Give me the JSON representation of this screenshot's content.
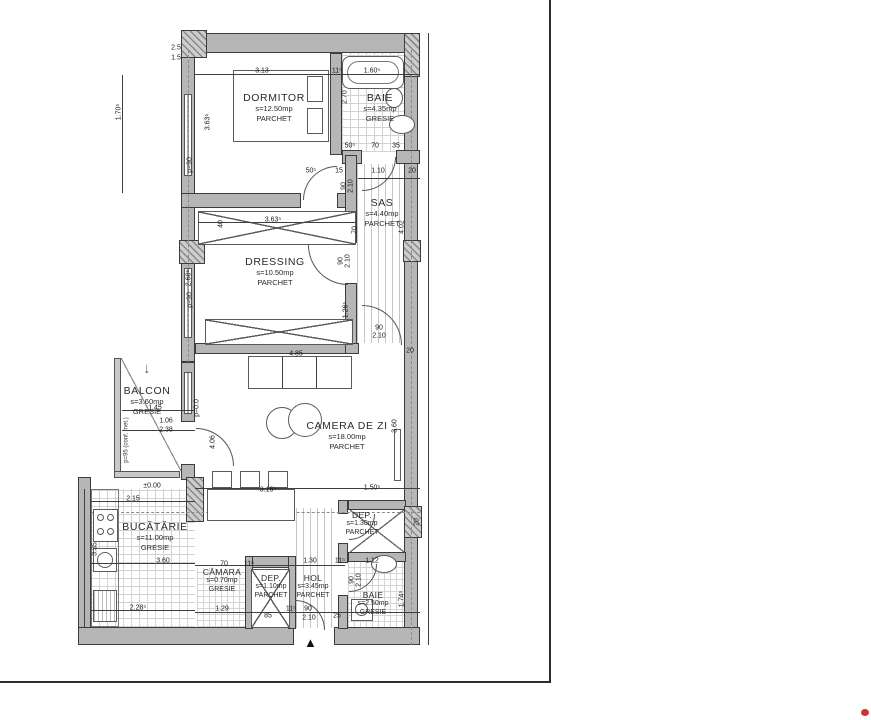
{
  "colors": {
    "wall": "#b6b6b6",
    "line": "#3c3c3c",
    "frame": "#2c2c2c",
    "dot": "#d03030"
  },
  "icons": {
    "balcony_arrow": "↓",
    "entrance_marker": "▲"
  },
  "rooms": [
    {
      "id": "dormitor",
      "name": "DORMITOR",
      "area": "s=12.50mp",
      "floor": "PARCHET",
      "x": 274,
      "y": 92
    },
    {
      "id": "baie-1",
      "name": "BAIE",
      "area": "s=4.35mp",
      "floor": "GRESIE",
      "x": 380,
      "y": 92
    },
    {
      "id": "sas",
      "name": "SAS",
      "area": "s=4.40mp",
      "floor": "PARCHET",
      "x": 382,
      "y": 197
    },
    {
      "id": "dressing",
      "name": "DRESSING",
      "area": "s=10.50mp",
      "floor": "PARCHET",
      "x": 275,
      "y": 256
    },
    {
      "id": "balcon",
      "name": "BALCON",
      "area": "s=3.60mp",
      "floor": "GRESIE",
      "x": 147,
      "y": 385
    },
    {
      "id": "camera-de-zi",
      "name": "CAMERA DE ZI",
      "area": "s=18.00mp",
      "floor": "PARCHET",
      "x": 347,
      "y": 420
    },
    {
      "id": "bucatarie",
      "name": "BUCĂTĂRIE",
      "area": "s=11.00mp",
      "floor": "GRESIE",
      "x": 155,
      "y": 521
    },
    {
      "id": "camara",
      "name": "CĂMARA",
      "area": "s=0.70mp",
      "floor": "GRESIE",
      "sm": 1,
      "x": 222,
      "y": 567
    },
    {
      "id": "dep-1",
      "name": "DEP.",
      "area": "s=1.10mp",
      "floor": "PARCHET",
      "sm": 1,
      "x": 271,
      "y": 573
    },
    {
      "id": "hol",
      "name": "HOL",
      "area": "s=3.45mp",
      "floor": "PARCHET",
      "sm": 1,
      "x": 313,
      "y": 573
    },
    {
      "id": "dep-2",
      "name": "DEP.",
      "area": "s=1.30mp",
      "floor": "PARCHET",
      "sm": 1,
      "x": 362,
      "y": 510
    },
    {
      "id": "baie-2",
      "name": "BAIE",
      "area": "s=2.50mp",
      "floor": "GRESIE",
      "sm": 1,
      "x": 373,
      "y": 590
    }
  ],
  "dims": [
    {
      "t": "2.5",
      "x": 176,
      "y": 48
    },
    {
      "t": "1.5",
      "x": 176,
      "y": 58
    },
    {
      "t": "3.13",
      "x": 262,
      "y": 71
    },
    {
      "t": "11⁵",
      "x": 337,
      "y": 71
    },
    {
      "t": "1.60⁵",
      "x": 372,
      "y": 71
    },
    {
      "t": "1.70⁵",
      "x": 119,
      "y": 112,
      "r": 1
    },
    {
      "t": "3.63⁵",
      "x": 208,
      "y": 122,
      "r": 1
    },
    {
      "t": "2.70",
      "x": 345,
      "y": 97,
      "r": 1
    },
    {
      "t": "50⁵",
      "x": 350,
      "y": 146
    },
    {
      "t": "70",
      "x": 375,
      "y": 146
    },
    {
      "t": "35",
      "x": 396,
      "y": 146
    },
    {
      "t": "50⁵",
      "x": 311,
      "y": 171
    },
    {
      "t": "15",
      "x": 339,
      "y": 171
    },
    {
      "t": "1.10",
      "x": 378,
      "y": 171
    },
    {
      "t": "20",
      "x": 412,
      "y": 171
    },
    {
      "t": "90",
      "x": 344,
      "y": 186,
      "r": 1
    },
    {
      "t": "2.10",
      "x": 351,
      "y": 186,
      "r": 1
    },
    {
      "t": "3.63⁵",
      "x": 273,
      "y": 220
    },
    {
      "t": "40",
      "x": 221,
      "y": 224,
      "r": 1
    },
    {
      "t": "70",
      "x": 355,
      "y": 230,
      "r": 1
    },
    {
      "t": "4.02",
      "x": 402,
      "y": 227,
      "r": 1
    },
    {
      "t": "2.68⁵",
      "x": 189,
      "y": 278,
      "r": 1
    },
    {
      "t": "90",
      "x": 341,
      "y": 261,
      "r": 1
    },
    {
      "t": "2.10",
      "x": 348,
      "y": 261,
      "r": 1
    },
    {
      "t": "1.26⁵",
      "x": 346,
      "y": 310,
      "r": 1
    },
    {
      "t": "90",
      "x": 379,
      "y": 328
    },
    {
      "t": "2.10",
      "x": 379,
      "y": 336
    },
    {
      "t": "20",
      "x": 410,
      "y": 351
    },
    {
      "t": "4.85",
      "x": 296,
      "y": 354
    },
    {
      "t": "p=90",
      "x": 190,
      "y": 165,
      "r": 1
    },
    {
      "t": "p=90",
      "x": 190,
      "y": 300,
      "r": 1
    },
    {
      "t": "p=0.0",
      "x": 197,
      "y": 408,
      "r": 1
    },
    {
      "t": "1.45",
      "x": 155,
      "y": 408
    },
    {
      "t": "1.06",
      "x": 166,
      "y": 421
    },
    {
      "t": "2.38",
      "x": 166,
      "y": 430
    },
    {
      "t": "4.06",
      "x": 213,
      "y": 442,
      "r": 1
    },
    {
      "t": "p=95 (conf. met.)",
      "x": 127,
      "y": 440,
      "r": 1,
      "s": 1
    },
    {
      "t": "±0.00",
      "x": 152,
      "y": 486
    },
    {
      "t": "2.15",
      "x": 133,
      "y": 499
    },
    {
      "t": "3.16⁵",
      "x": 268,
      "y": 490
    },
    {
      "t": "1.50⁵",
      "x": 372,
      "y": 488
    },
    {
      "t": "3.60",
      "x": 395,
      "y": 426,
      "r": 1
    },
    {
      "t": "3.35",
      "x": 95,
      "y": 549,
      "r": 1
    },
    {
      "t": "3.60",
      "x": 163,
      "y": 561
    },
    {
      "t": "2.28⁵",
      "x": 138,
      "y": 608
    },
    {
      "t": "70",
      "x": 224,
      "y": 564
    },
    {
      "t": "11⁵",
      "x": 249,
      "y": 564
    },
    {
      "t": "1.30",
      "x": 310,
      "y": 561
    },
    {
      "t": "11⁵",
      "x": 340,
      "y": 561
    },
    {
      "t": "1.12",
      "x": 372,
      "y": 561
    },
    {
      "t": "1.29",
      "x": 222,
      "y": 609
    },
    {
      "t": "11⁵",
      "x": 291,
      "y": 609
    },
    {
      "t": "85",
      "x": 268,
      "y": 616
    },
    {
      "t": "90",
      "x": 308,
      "y": 609
    },
    {
      "t": "2.10",
      "x": 309,
      "y": 618
    },
    {
      "t": "25",
      "x": 337,
      "y": 616
    },
    {
      "t": "90",
      "x": 352,
      "y": 580,
      "r": 1
    },
    {
      "t": "2.10",
      "x": 359,
      "y": 580,
      "r": 1
    },
    {
      "t": "1.74⁵",
      "x": 402,
      "y": 599,
      "r": 1
    },
    {
      "t": "20",
      "x": 417,
      "y": 522,
      "r": 1
    }
  ]
}
